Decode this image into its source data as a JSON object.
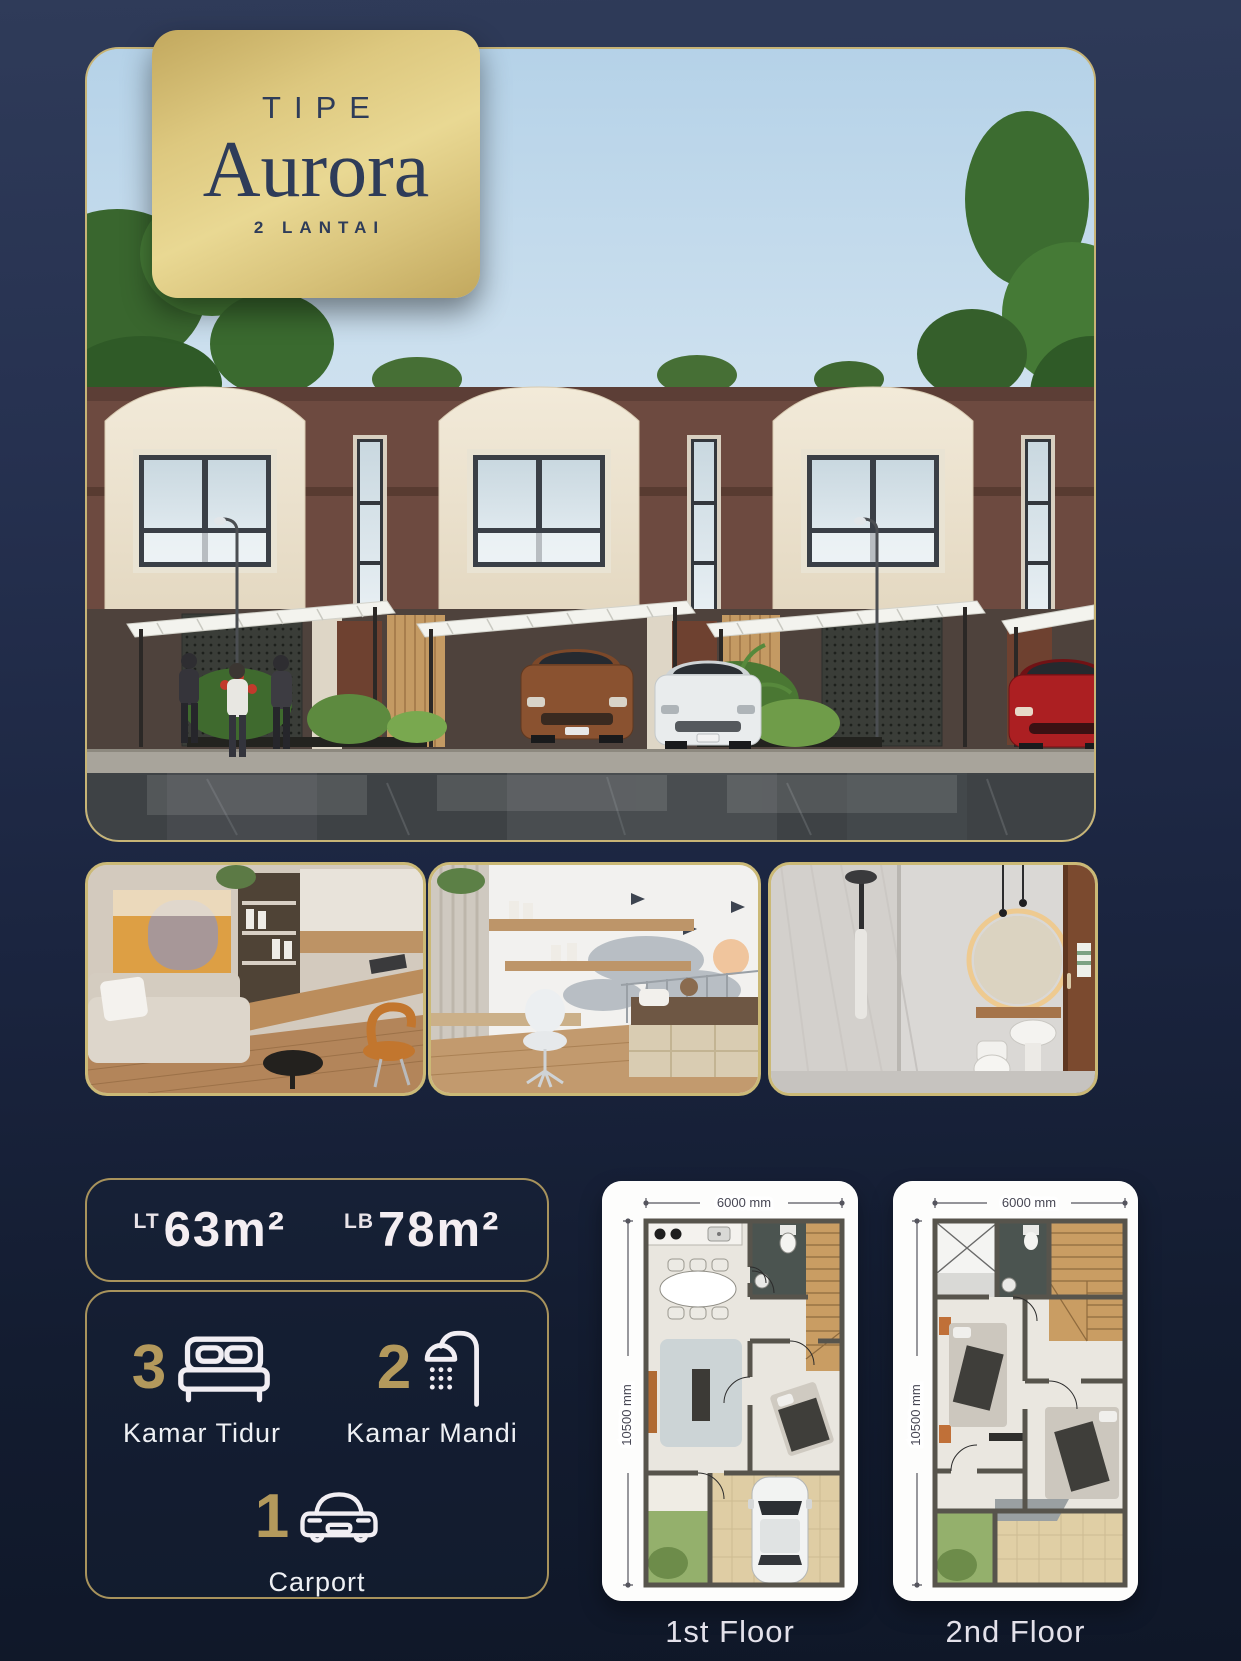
{
  "badge": {
    "eyebrow": "TIPE",
    "title": "Aurora",
    "subtitle": "2 LANTAI"
  },
  "specs": {
    "lt_label": "LT",
    "lt_value": "63m²",
    "lb_label": "LB",
    "lb_value": "78m²"
  },
  "features": [
    {
      "count": "3",
      "label": "Kamar Tidur",
      "icon": "bed-icon"
    },
    {
      "count": "2",
      "label": "Kamar Mandi",
      "icon": "shower-icon"
    },
    {
      "count": "1",
      "label": "Carport",
      "icon": "car-icon"
    }
  ],
  "floor_plans": [
    {
      "label": "1st Floor",
      "width_dim": "6000 mm",
      "height_dim": "10500 mm"
    },
    {
      "label": "2nd Floor",
      "width_dim": "6000 mm",
      "height_dim": "10500 mm"
    }
  ],
  "colors": {
    "gold_border": "#cbb976",
    "badge_gold": "#ddc87f",
    "navy_text": "#2e3c59",
    "page_navy": "#1b2540",
    "number_gold": "#b3995c",
    "white_text": "#f4eef2"
  }
}
